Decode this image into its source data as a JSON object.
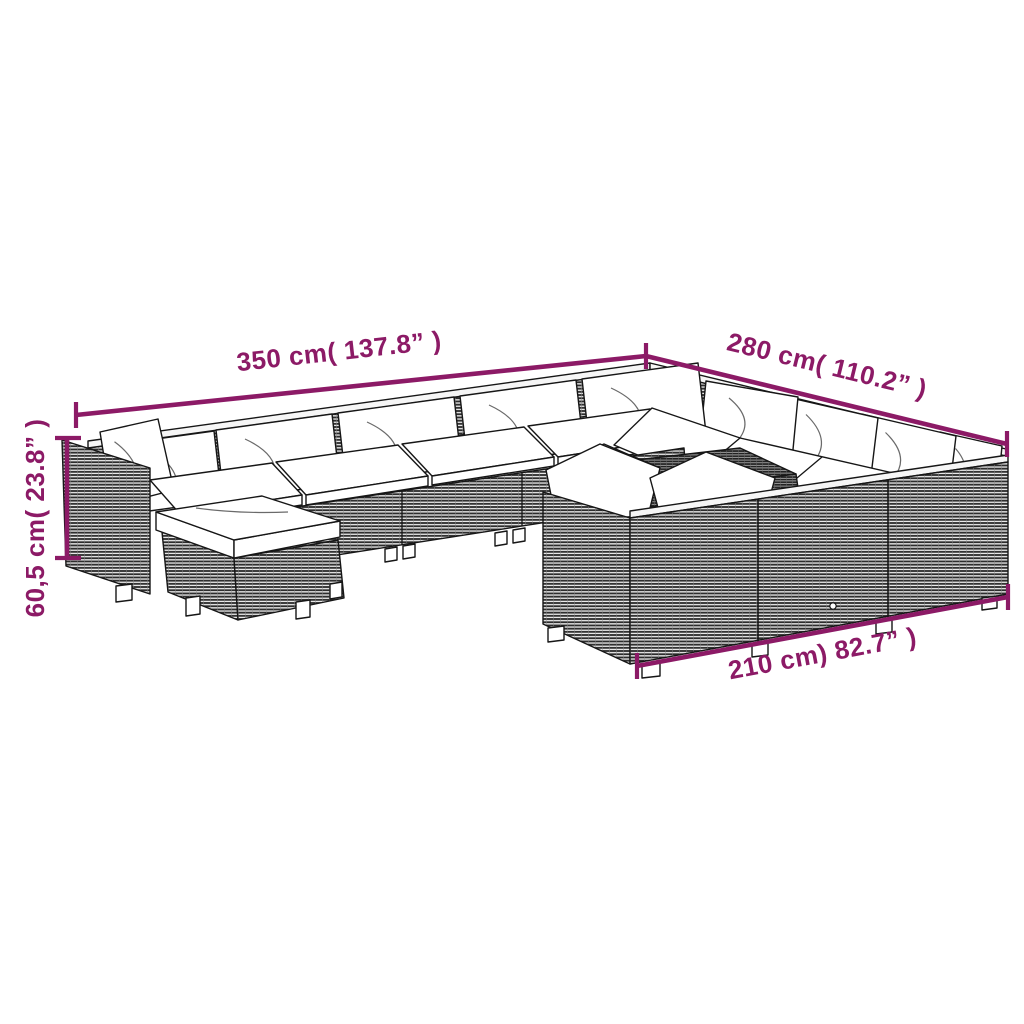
{
  "image_type": "product dimension diagram",
  "subject": "poly rattan garden lounge set with white cushions (black-and-white line drawing)",
  "colors": {
    "annotation": "#8C1A66",
    "outline": "#161616",
    "cushion": "#ffffff",
    "rattan": "#3a3a3a",
    "background": "#ffffff"
  },
  "dimensions": {
    "back_width_label": "350 cm( 137.8” )",
    "right_depth_label": "280 cm( 110.2” )",
    "height_label": "60,5 cm( 23.8” )",
    "front_width_label": "210 cm) 82.7” )",
    "back_width_cm": 350,
    "back_width_in": 137.8,
    "right_depth_cm": 280,
    "right_depth_in": 110.2,
    "height_cm": "60,5",
    "height_in": 23.8,
    "front_width_cm": 210,
    "front_width_in": 82.7
  }
}
